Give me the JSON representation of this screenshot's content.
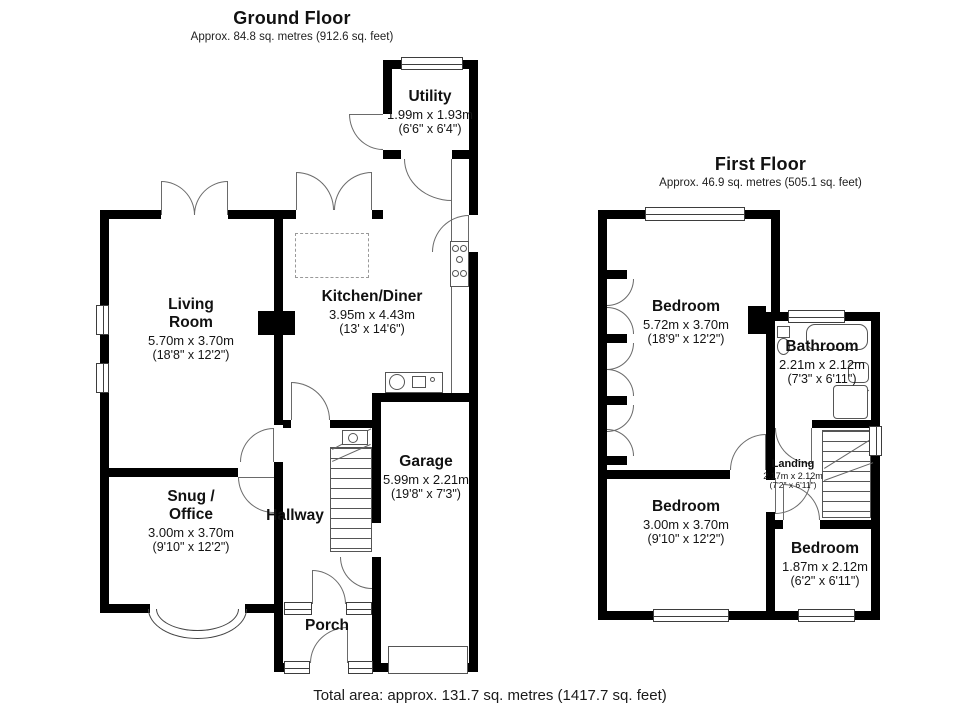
{
  "ground_floor": {
    "title": "Ground Floor",
    "area": "Approx. 84.8 sq. metres (912.6 sq. feet)",
    "rooms": {
      "living": {
        "name": "Living Room",
        "metric": "5.70m x 3.70m",
        "imperial": "(18'8\" x 12'2\")"
      },
      "kitchen": {
        "name": "Kitchen/Diner",
        "metric": "3.95m x 4.43m",
        "imperial": "(13' x 14'6\")"
      },
      "utility": {
        "name": "Utility",
        "metric": "1.99m x 1.93m",
        "imperial": "(6'6\" x 6'4\")"
      },
      "snug": {
        "name": "Snug / Office",
        "metric": "3.00m x 3.70m",
        "imperial": "(9'10\" x 12'2\")"
      },
      "hallway": {
        "name": "Hallway"
      },
      "garage": {
        "name": "Garage",
        "metric": "5.99m x 2.21m",
        "imperial": "(19'8\" x 7'3\")"
      },
      "porch": {
        "name": "Porch"
      }
    }
  },
  "first_floor": {
    "title": "First Floor",
    "area": "Approx. 46.9 sq. metres (505.1 sq. feet)",
    "rooms": {
      "bedroom_main": {
        "name": "Bedroom",
        "metric": "5.72m x 3.70m",
        "imperial": "(18'9\" x 12'2\")"
      },
      "bathroom": {
        "name": "Bathroom",
        "metric": "2.21m x 2.12m",
        "imperial": "(7'3\" x 6'11\")"
      },
      "landing": {
        "name": "Landing",
        "metric": "2.17m x 2.12m",
        "imperial": "(7'2\" x 6'11\")"
      },
      "bedroom_2": {
        "name": "Bedroom",
        "metric": "3.00m x 3.70m",
        "imperial": "(9'10\" x 12'2\")"
      },
      "bedroom_3": {
        "name": "Bedroom",
        "metric": "1.87m x 2.12m",
        "imperial": "(6'2\" x 6'11\")"
      }
    }
  },
  "footer": {
    "total_area": "Total area: approx. 131.7 sq. metres (1417.7 sq. feet)"
  },
  "colors": {
    "wall": "#000000",
    "fixture_line": "#555555",
    "room_fill": "#ffffff"
  }
}
